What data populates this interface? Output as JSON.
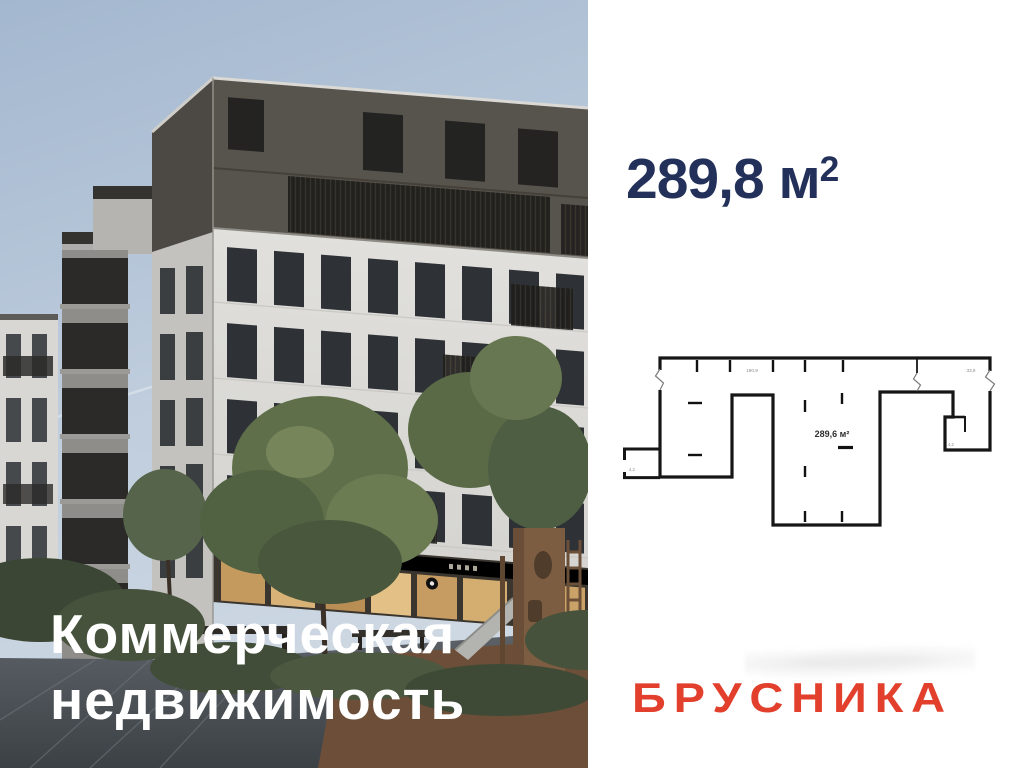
{
  "photo": {
    "title_line1": "Коммерческая",
    "title_line2": "недвижимость"
  },
  "listing": {
    "area_value": "289,8",
    "area_unit": " м",
    "area_power": "2",
    "brand": "БРУСНИКА"
  },
  "floorplan": {
    "area_label": "289,6 м²",
    "dims": {
      "top_left": "190,9",
      "top_right": "33,9",
      "annex": "4,2",
      "bath": "4,2"
    }
  },
  "colors": {
    "accent_navy": "#23315a",
    "brand_red": "#e2402d",
    "plan_wall": "#161616",
    "overlay_text": "#ffffff"
  }
}
